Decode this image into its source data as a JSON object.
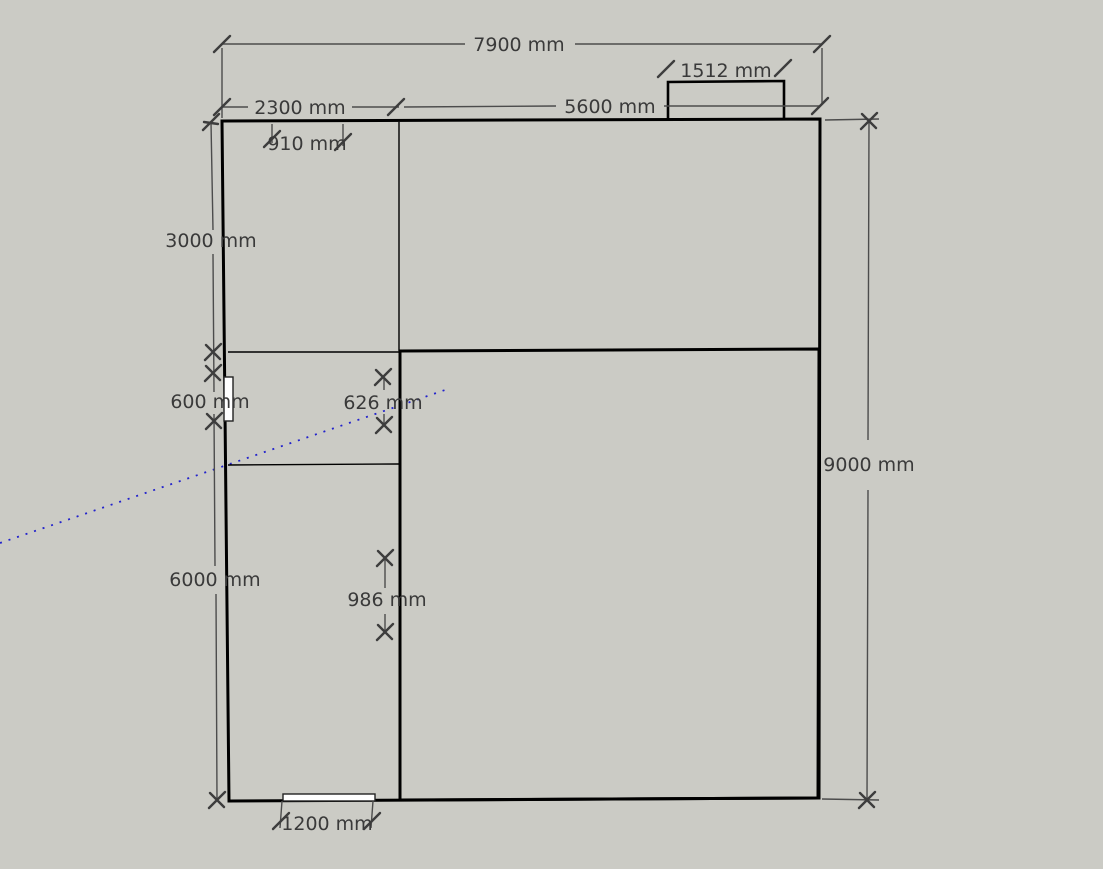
{
  "app": {
    "name": "3d-model-floor-plan-view"
  },
  "canvas": {
    "background_color": "#cbcbc5",
    "face_white_color": "#ffffff",
    "face_gray_color": "#c9c9c3",
    "guide_color": "#2222cc",
    "text_color": "#3a3a3a"
  },
  "dimensions": {
    "total_width": "7900 mm",
    "notch_width": "1512 mm",
    "left_bay_width": "2300 mm",
    "right_bay_width": "5600 mm",
    "top_opening_width": "910 mm",
    "top_room_depth": "3000 mm",
    "left_opening_height": "600 mm",
    "mid_opening_626": "626 mm",
    "total_height": "9000 mm",
    "left_wing_depth": "6000 mm",
    "mid_opening_986": "986 mm",
    "bottom_door_width": "1200 mm"
  }
}
